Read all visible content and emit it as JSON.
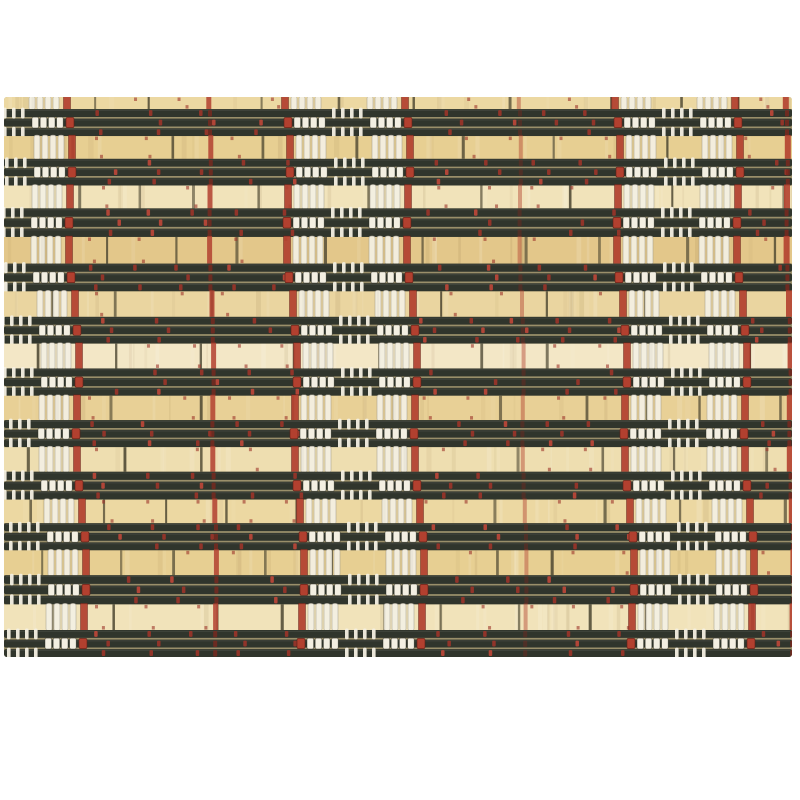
{
  "scene": {
    "type": "product-photo",
    "subject": "woven bamboo placemat with black slat bands, natural tan bamboo strips, white bead warp threads and red warp threads",
    "background_color": "#ffffff"
  },
  "mat": {
    "x": 4,
    "y": 97,
    "width": 788,
    "height": 560,
    "dark_bands": 11,
    "tan_strips": 11,
    "slats_per_band": 3,
    "top_strip_height": 12,
    "avg_tan_height": 24.5,
    "avg_band_height": 27.5
  },
  "weave": {
    "warp_zone_centers_x": [
      10,
      348,
      678
    ],
    "zone_column_offsets": [
      -54,
      22
    ],
    "zone_column_width": 32,
    "zone_red_flank_offset": 60,
    "lone_red_warps_x": [
      210,
      520,
      787
    ],
    "lone_red_opacity": [
      0.85,
      0.45,
      0.9
    ],
    "lone_red_width": [
      5,
      4,
      6
    ],
    "red_stitch_spacing": 45,
    "beads_per_group": 4,
    "ticks_per_group": 4
  },
  "palette": {
    "background": "#ffffff",
    "weave_base": "#9a8f6a",
    "slat_dark": "#30352c",
    "slat_highlight": "#ffffff",
    "bamboo_tones": [
      "#ecd8a2",
      "#e7cf92",
      "#f1e3ba",
      "#e3c78a",
      "#ead5a0",
      "#f3e7c6",
      "#e8d096",
      "#eedeb0"
    ],
    "segment_line": "#45402c",
    "grain_dark": "#7a5c2e",
    "thread_white": "#f4f0e3",
    "bead_white": "#f3efe2",
    "bead_stroke": "#2a2a20",
    "thread_red": "#b2402f",
    "thread_red_dark": "#7d281e",
    "stitch_red": "#9c3429",
    "stitch_red_bright": "#c04739",
    "flank_red_stroke": "#5f1f17"
  },
  "seed": 7
}
